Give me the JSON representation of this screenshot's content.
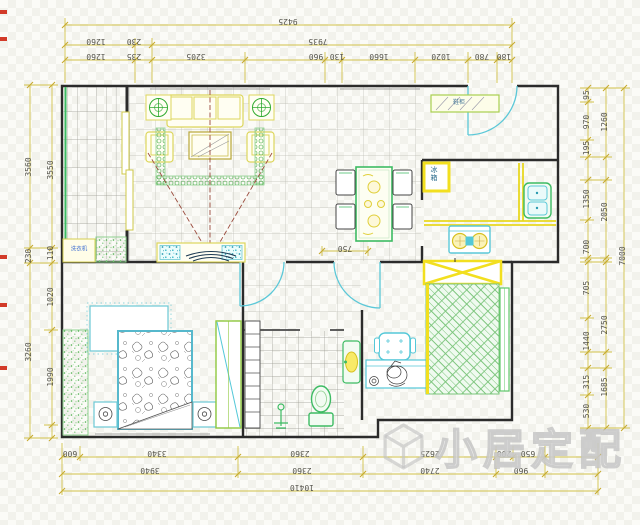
{
  "document": {
    "type": "apartment-floor-plan",
    "units": "mm"
  },
  "colors": {
    "dimension_line": "#d2c24a",
    "dimension_text": "#55544c",
    "wall": "#2b2b2b",
    "furniture_green": "#3dbb63",
    "furniture_cyan": "#54c8d8",
    "furniture_yellow": "#f2df1f",
    "sofa_yellow": "#ddd65c",
    "projection_red": "#9a4a3c",
    "label_blue": "#3b6bd0",
    "edge_mark_red": "#d23a28",
    "watermark_gray": "#c9c9c9"
  },
  "dims": {
    "top": {
      "r1": [
        "9425"
      ],
      "r2": [
        "1260",
        "230",
        "7935"
      ],
      "r3": [
        "1260",
        "235",
        "3205",
        "960",
        "130",
        "1660",
        "1020",
        "780",
        "180"
      ]
    },
    "bottom": {
      "r1": [
        "600",
        "3340",
        "2360",
        "2625",
        "200",
        "650"
      ],
      "r2": [
        "3940",
        "2360",
        "2740",
        "960"
      ],
      "r3": [
        "10410"
      ]
    },
    "left": {
      "outer": [
        "3560",
        "230",
        "3260"
      ],
      "inner": [
        "3550",
        "110",
        "1020",
        "1990"
      ]
    },
    "right": {
      "inner": [
        "95",
        "970",
        "195",
        "1350",
        "700",
        "705",
        "1440",
        "315",
        "530"
      ],
      "middle": [
        "1260",
        "2050",
        "2750",
        "1685"
      ],
      "outer": [
        "7000"
      ]
    },
    "dining_clearance": "750"
  },
  "labels": {
    "washer": "洗衣机",
    "shoe_cabinet": "鞋柜",
    "fridge": "冰箱"
  },
  "watermark": {
    "logo": "cube-logo",
    "text": "小居定配"
  }
}
